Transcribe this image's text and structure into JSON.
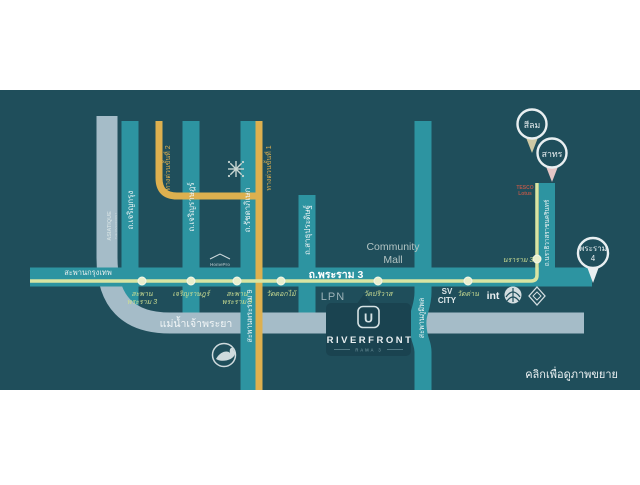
{
  "map": {
    "zoom_hint": "คลิกเพื่อดูภาพขยาย",
    "river_name": "แม่น้ำเจ้าพระยา"
  },
  "markers": {
    "silom": "สีลม",
    "sathorn": "สาทร",
    "rama4_line1": "พระราม",
    "rama4_line2": "4"
  },
  "roads": {
    "main": "ถ.พระราม 3",
    "krungthep_bridge": "สะพานกรุงเทพ",
    "charoenkrung": "ถ.เจริญกรุง",
    "charoenrat": "ถ.เจริญราษฎร์",
    "ratchadaphisek": "ถ.รัชดาภิเษก",
    "sathupradit": "ถ.สาธุประดิษฐ์",
    "rama9_bridge": "สะพานพระราม 9",
    "bhumibol_bridge": "สะพานภูมิพล",
    "narathiwat": "ถ.นราธิวาสราชนครินทร์",
    "expressway1": "ทางด่วนขั้นที่ 1",
    "expressway2": "ทางด่วนขั้นที่ 2"
  },
  "stops": {
    "rama3_bridge_l1": "สะพาน",
    "rama3_bridge_l2": "พระราม 3",
    "charoenrat": "เจริญราษฎร์",
    "rama9_bridge_l1": "สะพาน",
    "rama9_bridge_l2": "พระราม 9",
    "wat_dokmai": "วัดดอกไม้",
    "wat_pariwat": "วัดปริวาส",
    "wat_dan": "วัดด่าน",
    "nararam3": "นราราม 3"
  },
  "landmarks": {
    "asiatique_line1": "ASIATIQUE",
    "asiatique_line2": "THE RIVERFRONT",
    "tesco_line1": "TESCO",
    "tesco_line2": "Lotus",
    "community_line1": "Community",
    "community_line2": "Mall",
    "lpn": "LPN",
    "sv_line1": "SV",
    "sv_line2": "CITY",
    "int": "int",
    "homepro": "HomePro"
  },
  "project": {
    "logo_letter": "U",
    "name": "RIVERFRONT",
    "sub_label": "RAMA 3"
  },
  "colors": {
    "panel": "#1f4e5b",
    "road": "#2d94a1",
    "river": "#a5bcc8",
    "expressway": "#ddb04f",
    "route_line": "#d9e5a3",
    "stop_label": "#cbdd92",
    "silom_pointer": "#cfc9a4",
    "sathorn_pointer": "#e5c6c6",
    "rama4_pointer": "#e9eff1"
  }
}
